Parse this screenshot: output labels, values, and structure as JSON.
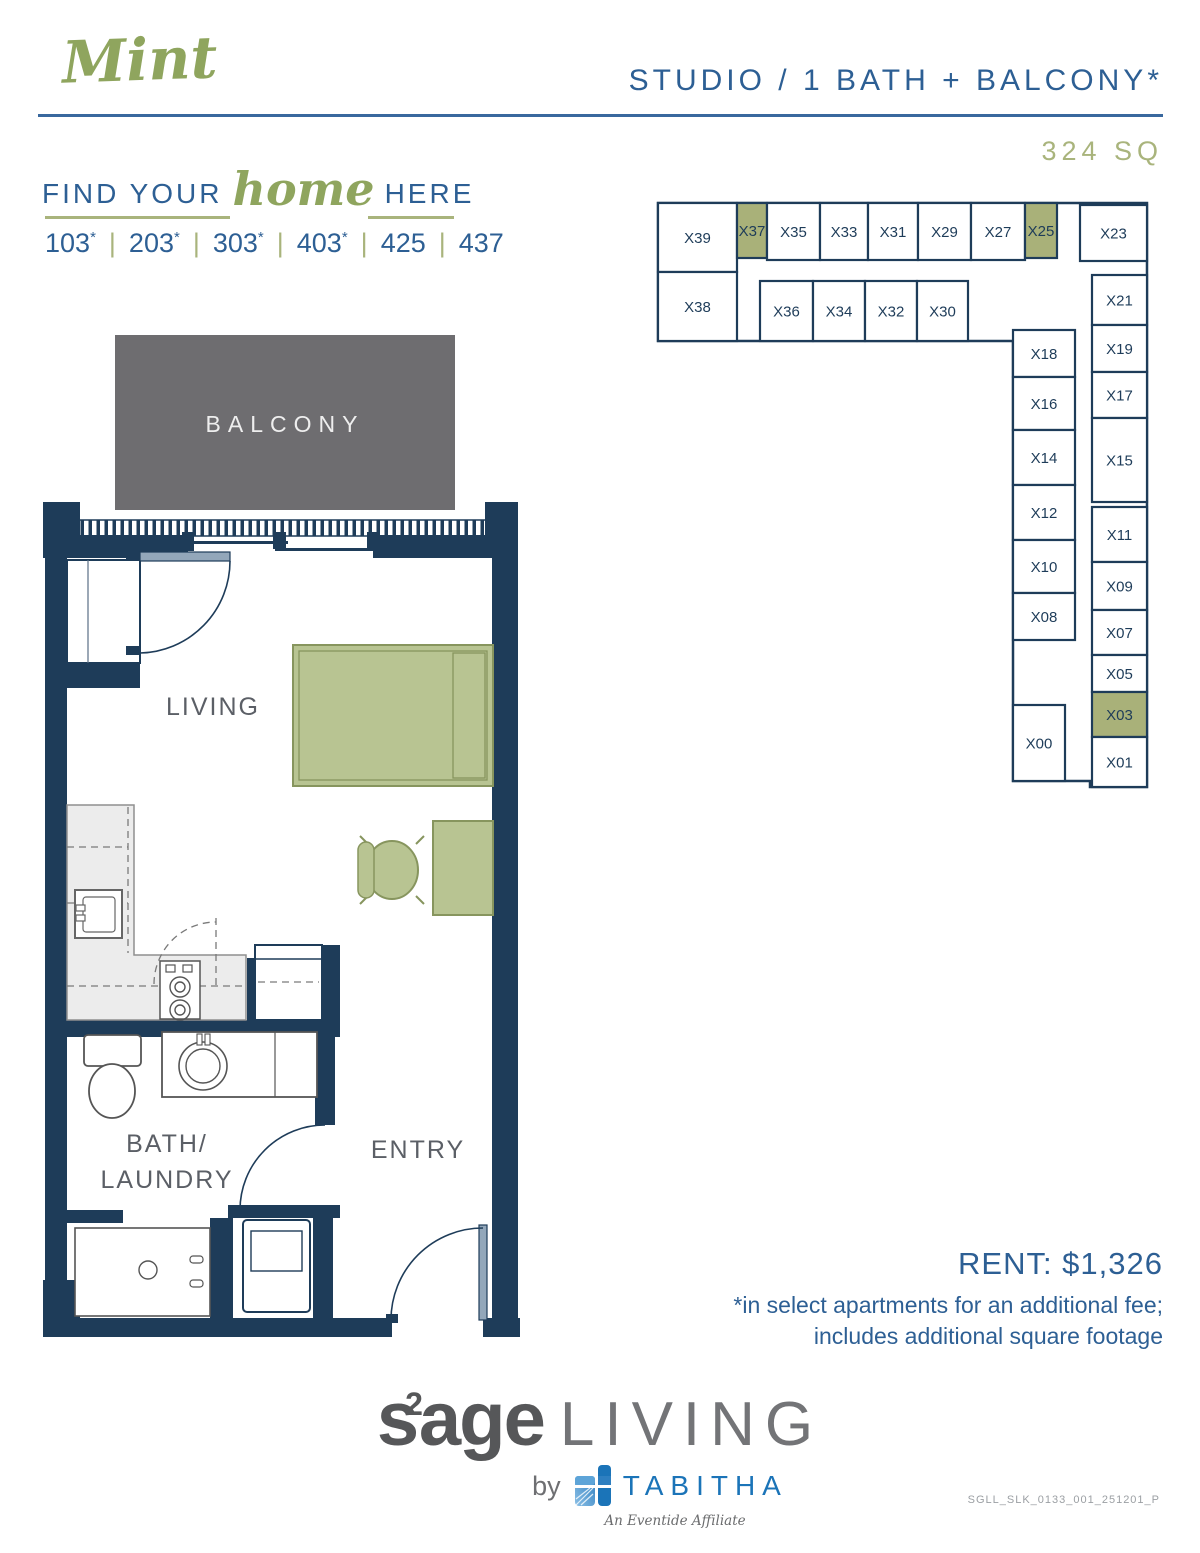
{
  "header": {
    "plan_name": "Mint",
    "plan_type": "STUDIO / 1 BATH + BALCONY*",
    "square_footage": "324 SQ",
    "tagline_pre": "FIND YOUR",
    "tagline_script": "home",
    "tagline_post": "HERE",
    "units": [
      "103*",
      "203*",
      "303*",
      "403*",
      "425",
      "437"
    ]
  },
  "floor_plan": {
    "labels": {
      "balcony": "BALCONY",
      "living": "LIVING",
      "bath_line1": "BATH/",
      "bath_line2": "LAUNDRY",
      "entry": "ENTRY"
    }
  },
  "key_plan": {
    "highlight_color": "#a9b179",
    "cell_fill": "#ffffff",
    "stroke_color": "#1e3c59",
    "cells": [
      {
        "label": "X39",
        "x": 8,
        "y": 8,
        "w": 79,
        "h": 69,
        "hl": false
      },
      {
        "label": "X37",
        "x": 87,
        "y": 8,
        "w": 30,
        "h": 55,
        "hl": true
      },
      {
        "label": "X35",
        "x": 117,
        "y": 8,
        "w": 53,
        "h": 57,
        "hl": false
      },
      {
        "label": "X33",
        "x": 170,
        "y": 8,
        "w": 48,
        "h": 57,
        "hl": false
      },
      {
        "label": "X31",
        "x": 218,
        "y": 8,
        "w": 50,
        "h": 57,
        "hl": false
      },
      {
        "label": "X29",
        "x": 268,
        "y": 8,
        "w": 53,
        "h": 57,
        "hl": false
      },
      {
        "label": "X27",
        "x": 321,
        "y": 8,
        "w": 54,
        "h": 57,
        "hl": false
      },
      {
        "label": "X25",
        "x": 375,
        "y": 8,
        "w": 32,
        "h": 55,
        "hl": true
      },
      {
        "label": "X23",
        "x": 430,
        "y": 10,
        "w": 67,
        "h": 56,
        "hl": false
      },
      {
        "label": "X38",
        "x": 8,
        "y": 77,
        "w": 79,
        "h": 69,
        "hl": false
      },
      {
        "label": "X36",
        "x": 110,
        "y": 86,
        "w": 53,
        "h": 60,
        "hl": false
      },
      {
        "label": "X34",
        "x": 163,
        "y": 86,
        "w": 52,
        "h": 60,
        "hl": false
      },
      {
        "label": "X32",
        "x": 215,
        "y": 86,
        "w": 52,
        "h": 60,
        "hl": false
      },
      {
        "label": "X30",
        "x": 267,
        "y": 86,
        "w": 51,
        "h": 60,
        "hl": false
      },
      {
        "label": "X18",
        "x": 363,
        "y": 135,
        "w": 62,
        "h": 47,
        "hl": false
      },
      {
        "label": "X16",
        "x": 363,
        "y": 182,
        "w": 62,
        "h": 53,
        "hl": false
      },
      {
        "label": "X14",
        "x": 363,
        "y": 235,
        "w": 62,
        "h": 55,
        "hl": false
      },
      {
        "label": "X12",
        "x": 363,
        "y": 290,
        "w": 62,
        "h": 55,
        "hl": false
      },
      {
        "label": "X10",
        "x": 363,
        "y": 345,
        "w": 62,
        "h": 53,
        "hl": false
      },
      {
        "label": "X08",
        "x": 363,
        "y": 398,
        "w": 62,
        "h": 47,
        "hl": false
      },
      {
        "label": "X00",
        "x": 363,
        "y": 510,
        "w": 52,
        "h": 76,
        "hl": false
      },
      {
        "label": "X21",
        "x": 442,
        "y": 80,
        "w": 55,
        "h": 50,
        "hl": false
      },
      {
        "label": "X19",
        "x": 442,
        "y": 130,
        "w": 55,
        "h": 47,
        "hl": false
      },
      {
        "label": "X17",
        "x": 442,
        "y": 177,
        "w": 55,
        "h": 46,
        "hl": false
      },
      {
        "label": "X15",
        "x": 442,
        "y": 223,
        "w": 55,
        "h": 84,
        "hl": false
      },
      {
        "label": "X11",
        "x": 442,
        "y": 312,
        "w": 55,
        "h": 55,
        "hl": false
      },
      {
        "label": "X09",
        "x": 442,
        "y": 367,
        "w": 55,
        "h": 48,
        "hl": false
      },
      {
        "label": "X07",
        "x": 442,
        "y": 415,
        "w": 55,
        "h": 45,
        "hl": false
      },
      {
        "label": "X05",
        "x": 442,
        "y": 460,
        "w": 55,
        "h": 37,
        "hl": false
      },
      {
        "label": "X03",
        "x": 442,
        "y": 497,
        "w": 55,
        "h": 45,
        "hl": true
      },
      {
        "label": "X01",
        "x": 442,
        "y": 542,
        "w": 55,
        "h": 50,
        "hl": false
      }
    ]
  },
  "pricing": {
    "rent": "RENT: $1,326",
    "note_line1": "*in select apartments for an additional fee;",
    "note_line2": "includes additional square footage"
  },
  "footer": {
    "brand_s": "s",
    "brand_sup": "2",
    "brand_age": "age",
    "brand_living": "LIVING",
    "by_label": "by",
    "tabitha": "TABITHA",
    "affiliate": "An Eventide Affiliate",
    "doc_code": "SGLL_SLK_0133_001_251201_P"
  },
  "colors": {
    "navy_wall": "#1e3c59",
    "heading_blue": "#2d5f94",
    "accent_green": "#8fa55e",
    "light_green": "#a9b47c",
    "sage_fill": "#b8c492",
    "balcony_gray": "#6e6d70",
    "tabitha_blue": "#1b74b8"
  }
}
